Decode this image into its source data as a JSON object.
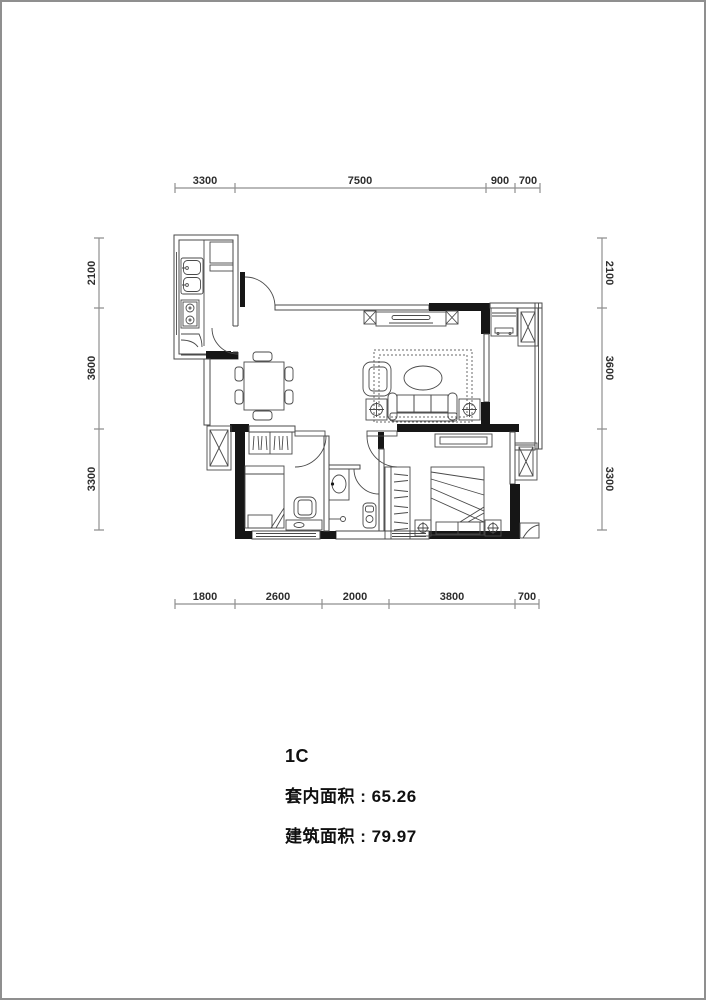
{
  "info": {
    "title": "1C",
    "inner_area": "套内面积 : 65.26",
    "gross_area": "建筑面积 : 79.97"
  },
  "dims": {
    "top": [
      "3300",
      "7500",
      "900",
      "700"
    ],
    "bottom": [
      "1800",
      "2600",
      "2000",
      "3800",
      "700"
    ],
    "left": [
      "2100",
      "3600",
      "3300"
    ],
    "right": [
      "2100",
      "3600",
      "3300"
    ]
  },
  "colors": {
    "wall": "#161616",
    "thin_line": "#4a4a4a",
    "dim_line": "#8f8f8f",
    "dim_text": "#2e2e2e",
    "page_border": "#8f8f8f"
  }
}
